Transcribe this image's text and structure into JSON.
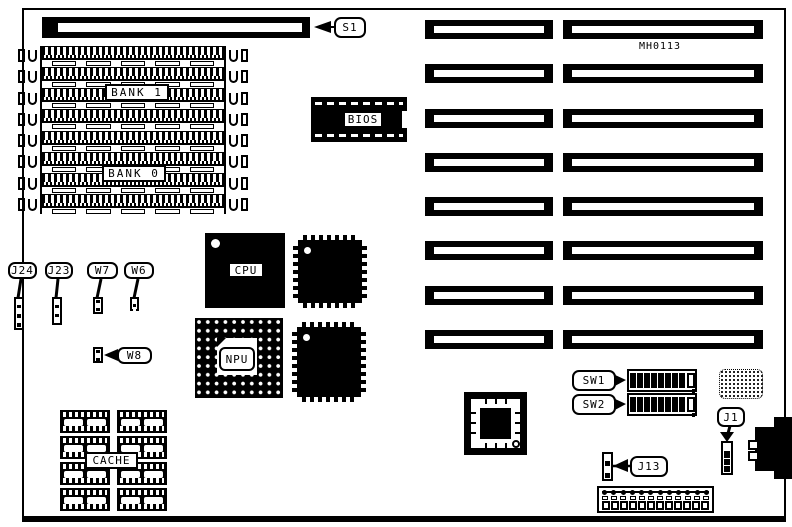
{
  "board": {
    "model": "MH0113"
  },
  "labels": {
    "s1": "S1",
    "bank1": "BANK 1",
    "bank0": "BANK 0",
    "bios": "BIOS",
    "cpu": "CPU",
    "npu": "NPU",
    "cache": "CACHE",
    "j24": "J24",
    "j23": "J23",
    "w7": "W7",
    "w6": "W6",
    "w8": "W8",
    "sw1": "SW1",
    "sw2": "SW2",
    "j1": "J1",
    "j13": "J13"
  },
  "colors": {
    "ink": "#000000",
    "paper": "#ffffff"
  },
  "counts": {
    "simm_rows": 8,
    "simm_gap_cells": 5,
    "latch_cells": 8,
    "slot_rows_left": 8,
    "slot_rows_right": 8,
    "cache_chips": 8,
    "dip_switch_positions": 8,
    "power_pins": 12,
    "j24_cells": 6,
    "j23_cells": 5,
    "w7_cells": 3,
    "w6_cells": 3,
    "w8_cells": 3,
    "j1_cells": 4,
    "j13_cells": 4
  }
}
